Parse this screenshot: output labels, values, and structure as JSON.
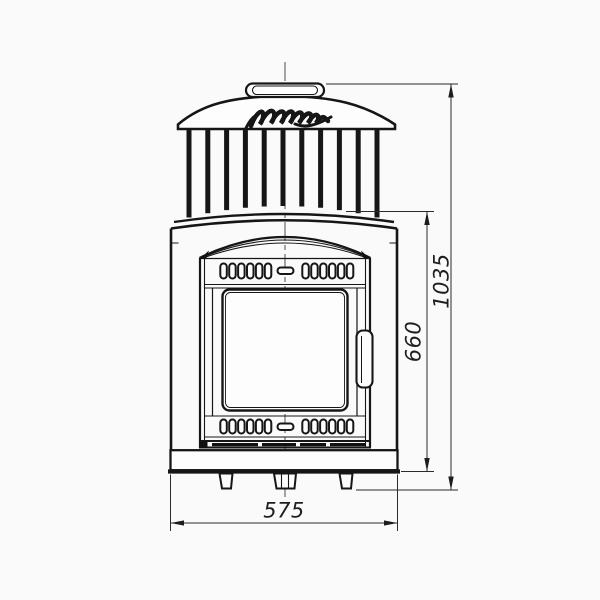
{
  "page": {
    "background": "#fafafa"
  },
  "drawing": {
    "line_color": "#161616",
    "dimension_line_color": "#2b2b2b",
    "icons": {
      "brand_logo": "cursive-signature-script"
    }
  },
  "dimensions": {
    "overall_width_label": "575",
    "door_section_height_label": "660",
    "overall_height_label": "1035"
  }
}
